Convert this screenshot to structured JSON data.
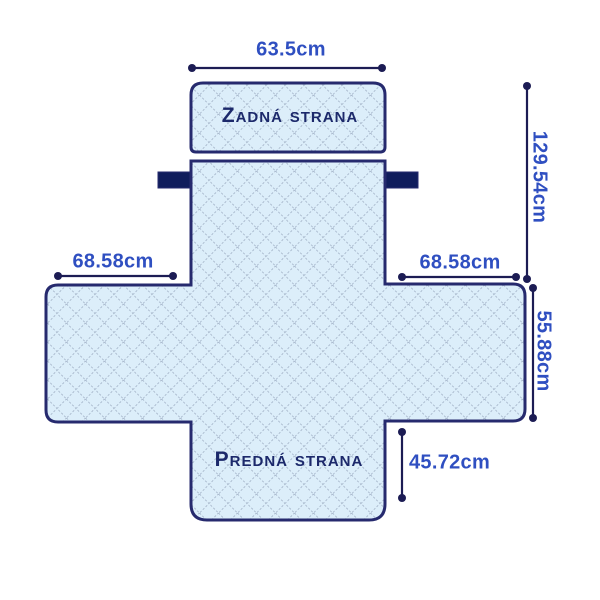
{
  "diagram": {
    "type": "sofa-cover-dimension-diagram",
    "back_panel_label": "Zadná strana",
    "front_panel_label": "Predná strana",
    "dimensions": {
      "top_width": "63.5cm",
      "back_height": "129.54cm",
      "left_armrest_width": "68.58cm",
      "right_armrest_width": "68.58cm",
      "armrest_depth": "55.88cm",
      "front_drop": "45.72cm"
    }
  },
  "colors": {
    "background": "#ffffff",
    "cover-fill": "#dceefa",
    "lattice": "#a9b9cd",
    "outline": "#262a6e",
    "tab": "#101d5c",
    "dim-line": "#1c1c54",
    "dim-text": "#2f4fc1",
    "label-text": "#1c296b"
  }
}
